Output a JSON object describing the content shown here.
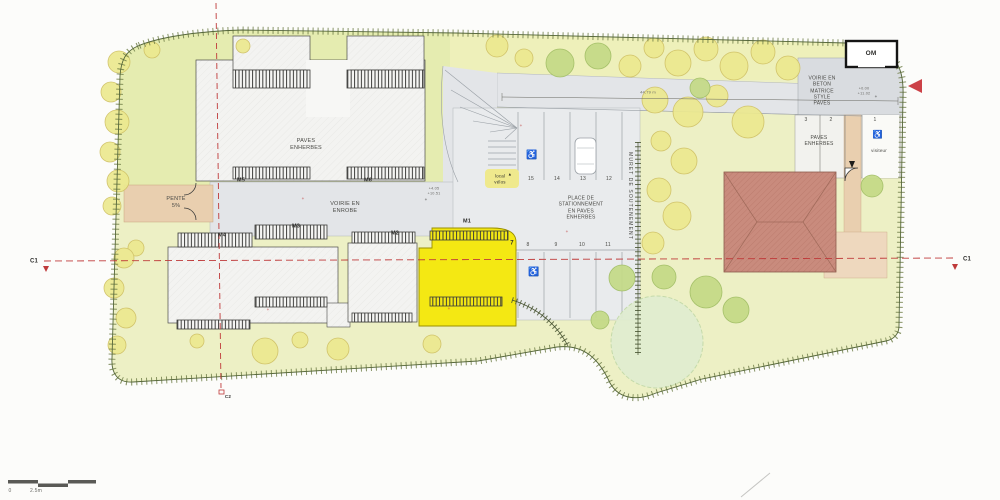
{
  "plan": {
    "areas": {
      "pente": "PENTE\n5%",
      "paves_enherbes_top": "PAVES\nENHERBES",
      "voirie_enrobe": "VOIRIE EN\nENROBE",
      "place_stationnement": "PLACE DE\nSTATIONNEMENT\nEN PAVES\nENHERBES",
      "muret": "MURET DE SOUTENEMENT",
      "voirie_beton": "VOIRIE EN\nBETON\nMATRICE\nSTYLE\nPAVES",
      "paves_enherbes_right": "PAVES\nENHERBES",
      "local_velos": "local\nvélos",
      "visiteur": "visiteur",
      "om": "OM"
    },
    "buildings": {
      "m1": "M1",
      "m2": "M2",
      "m3": "M3",
      "m4": "M4",
      "m5": "M5",
      "m6": "M6"
    },
    "parking": {
      "top_row": [
        "15",
        "14",
        "13",
        "12"
      ],
      "bottom_row": [
        "7",
        "8",
        "9",
        "10",
        "11"
      ],
      "right_row": [
        "3",
        "2",
        "1"
      ]
    },
    "dimensions": {
      "driveway_length": "44,79 m"
    },
    "elevations": {
      "entry": "+4.05\n+10.51",
      "om_area": "+0.00\n+11.02"
    },
    "sections": {
      "c1": "C1",
      "c2": "C2"
    },
    "scale_bar": {
      "zero": "0",
      "length": "2.5m"
    },
    "marks": {
      "plus": "+",
      "arrow_up": "▲",
      "handicap": "♿"
    }
  },
  "colors": {
    "grass": "#edf0c5",
    "grass_dark": "#e5ecb0",
    "road": "#e3e5e8",
    "beton": "#d9dce0",
    "beige_path": "#e9cfaf",
    "yellow_building": "#f4e813",
    "roof": "#c98b7d",
    "section_red": "#bf3a3a",
    "tree_yellow": "#ece98f",
    "tree_green": "#c4da86",
    "tree_pale": "#e0edd0",
    "paves_patch": "#dae4c9"
  }
}
